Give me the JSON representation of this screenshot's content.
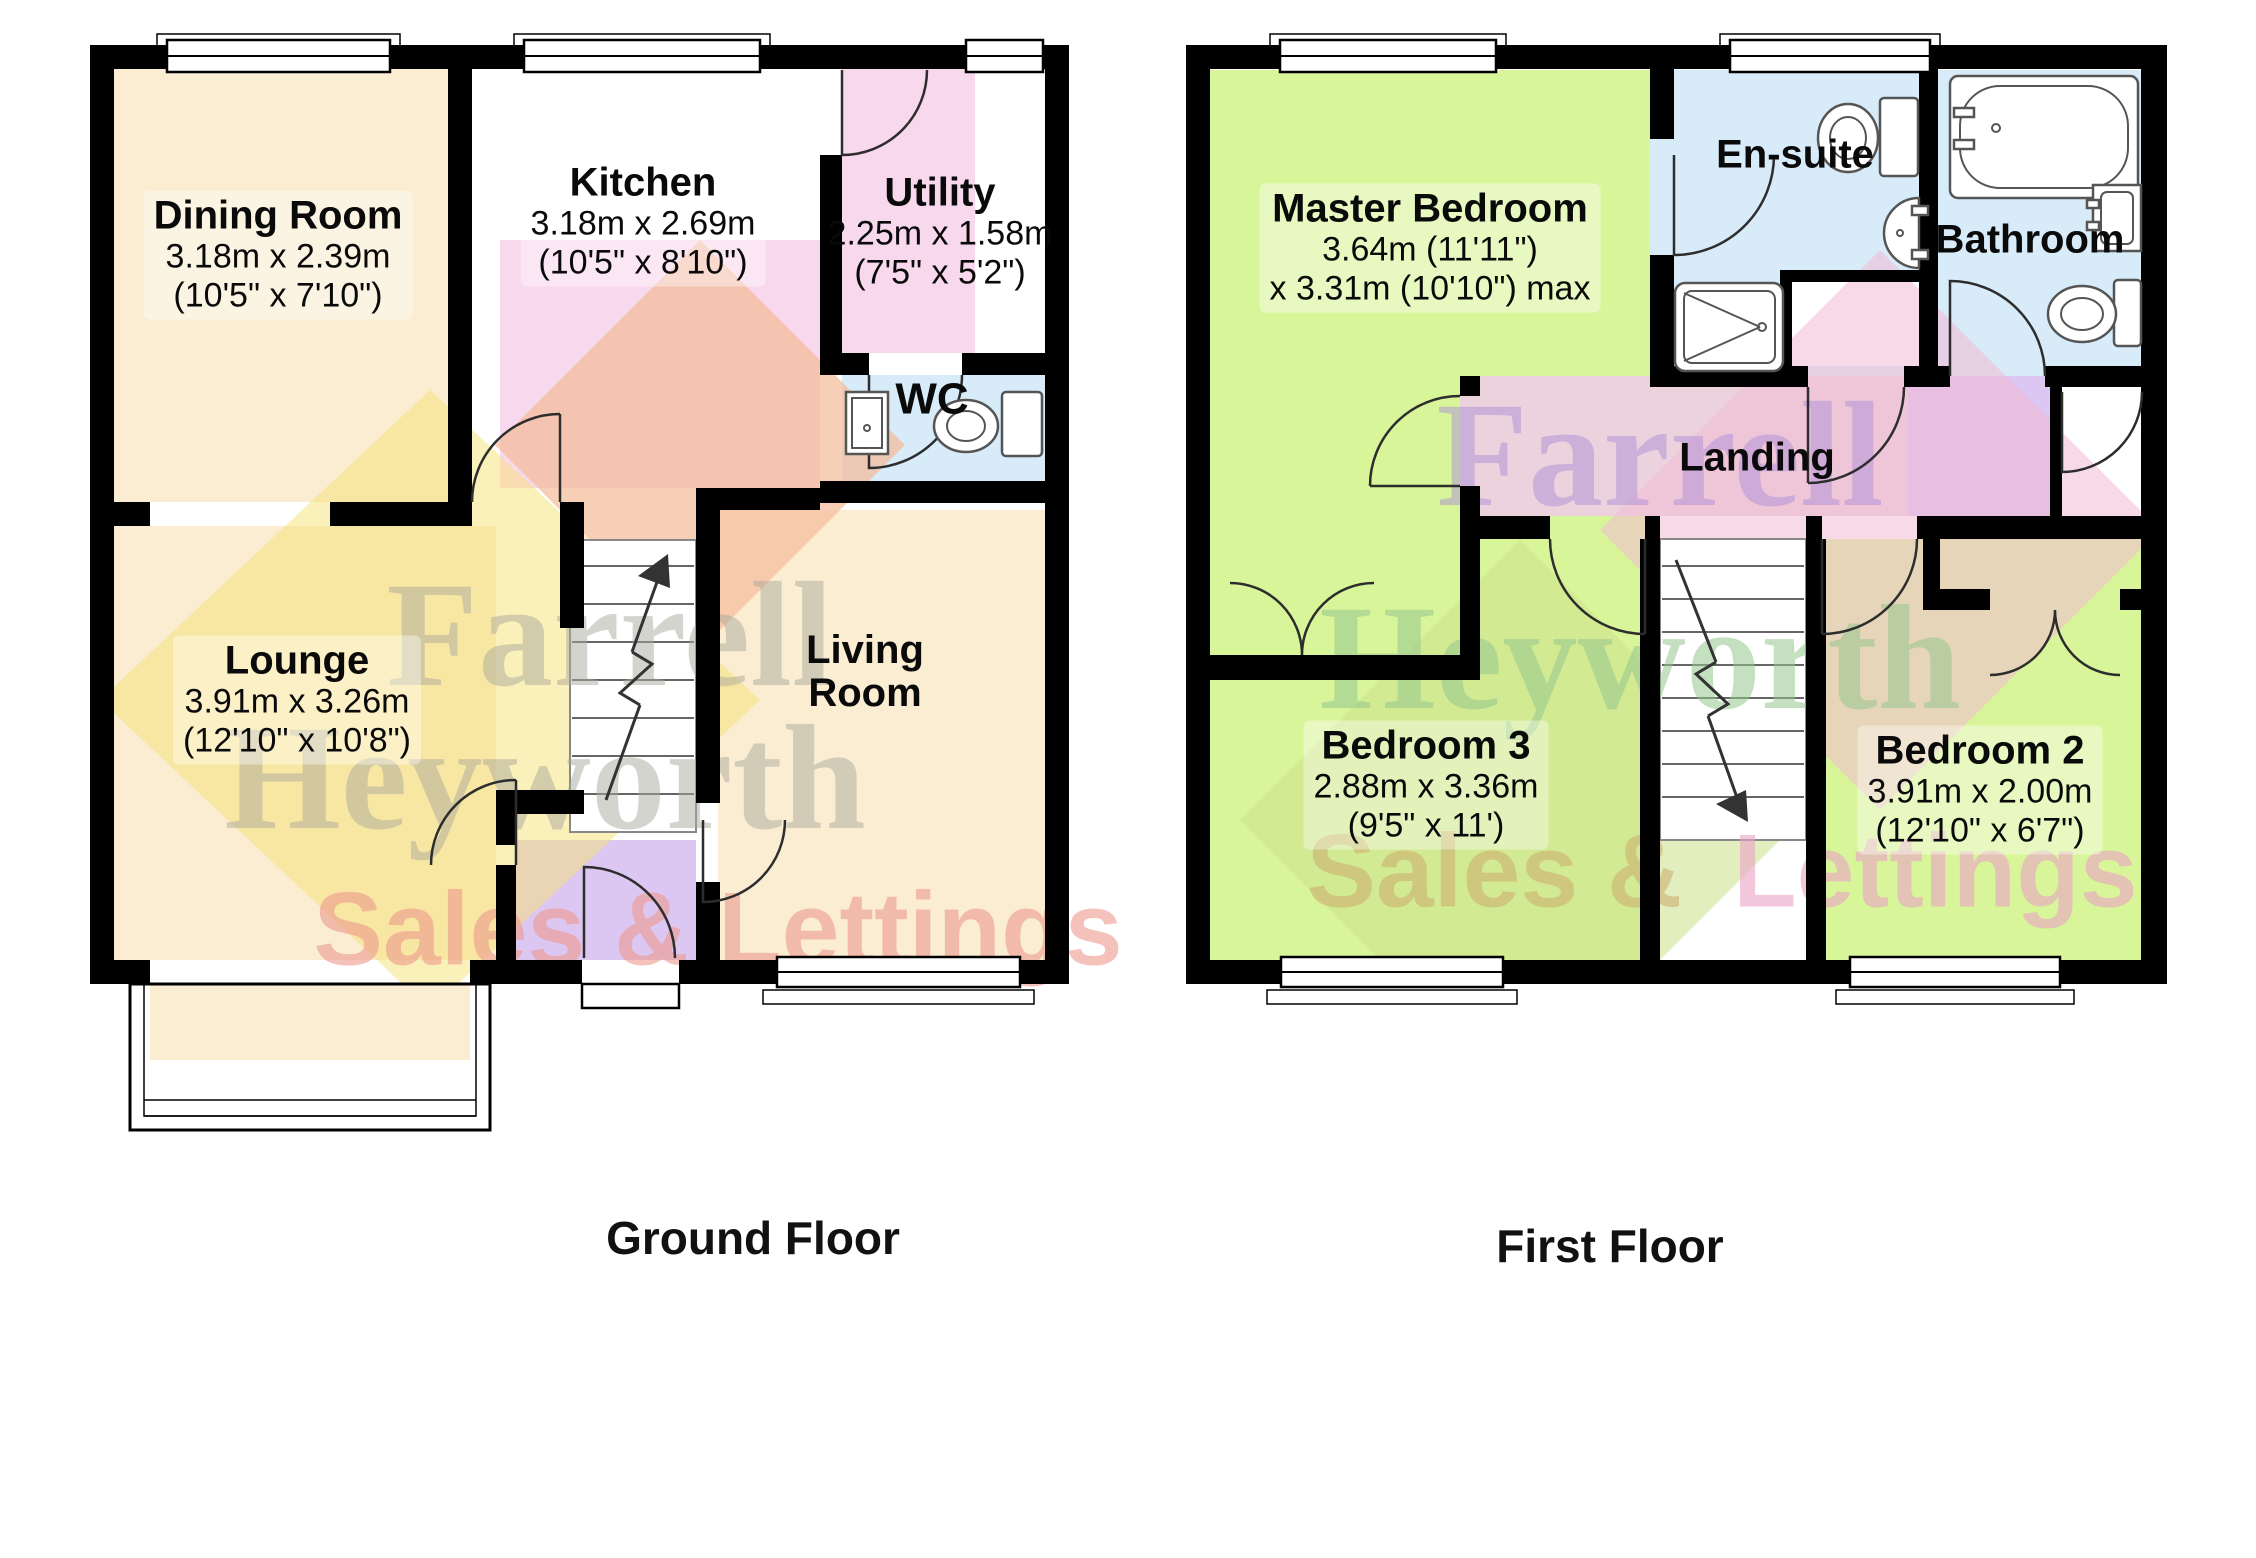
{
  "ground_floor": {
    "title": "Ground Floor",
    "rooms": {
      "dining": {
        "name": "Dining Room",
        "dims1": "3.18m x 2.39m",
        "dims2": "(10'5\" x 7'10\")"
      },
      "kitchen": {
        "name": "Kitchen",
        "dims1": "3.18m x 2.69m",
        "dims2": "(10'5\" x 8'10\")"
      },
      "utility": {
        "name": "Utility",
        "dims1": "2.25m x 1.58m",
        "dims2": "(7'5\" x 5'2\")"
      },
      "wc": {
        "name": "WC"
      },
      "lounge": {
        "name": "Lounge",
        "dims1": "3.91m x 3.26m",
        "dims2": "(12'10\" x 10'8\")"
      },
      "living": {
        "name": "Living Room"
      }
    }
  },
  "first_floor": {
    "title": "First Floor",
    "rooms": {
      "master": {
        "name": "Master Bedroom",
        "dims1": "3.64m (11'11\")",
        "dims2": "x 3.31m (10'10\") max"
      },
      "ensuite": {
        "name": "En-suite"
      },
      "bathroom": {
        "name": "Bathroom"
      },
      "landing": {
        "name": "Landing"
      },
      "bedroom3": {
        "name": "Bedroom 3",
        "dims1": "2.88m x 3.36m",
        "dims2": "(9'5\" x 11')"
      },
      "bedroom2": {
        "name": "Bedroom 2",
        "dims1": "3.91m x 2.00m",
        "dims2": "(12'10\" x 6'7\")"
      }
    }
  },
  "watermark": {
    "brand_line1": "Farrell",
    "brand_line2": "Heyworth",
    "brand_line3": "Sales & Lettings",
    "brand_line3a": "Sales &",
    "brand_line3b": "Lettings"
  },
  "colors": {
    "cream": "#FAEDD2",
    "pink": "#F8D8EC",
    "blue": "#D8EBF9",
    "purple": "#DCC6F2",
    "landing_pink": "#EBD2DD",
    "green": "#D9F59A",
    "wall": "#000000",
    "diamond_yellow": "#F6E273",
    "diamond_peach": "#F4BE9E",
    "diamond_pink": "#F2B9D3",
    "diamond_green": "#CCE08A",
    "wm_gray": "#ABAA9E",
    "wm_red": "#EE9A8E",
    "wm_purple": "#AC90D8",
    "wm_green": "#96C78F",
    "wm_tan": "#CDB071",
    "wm_pink": "#EBA3C6"
  }
}
